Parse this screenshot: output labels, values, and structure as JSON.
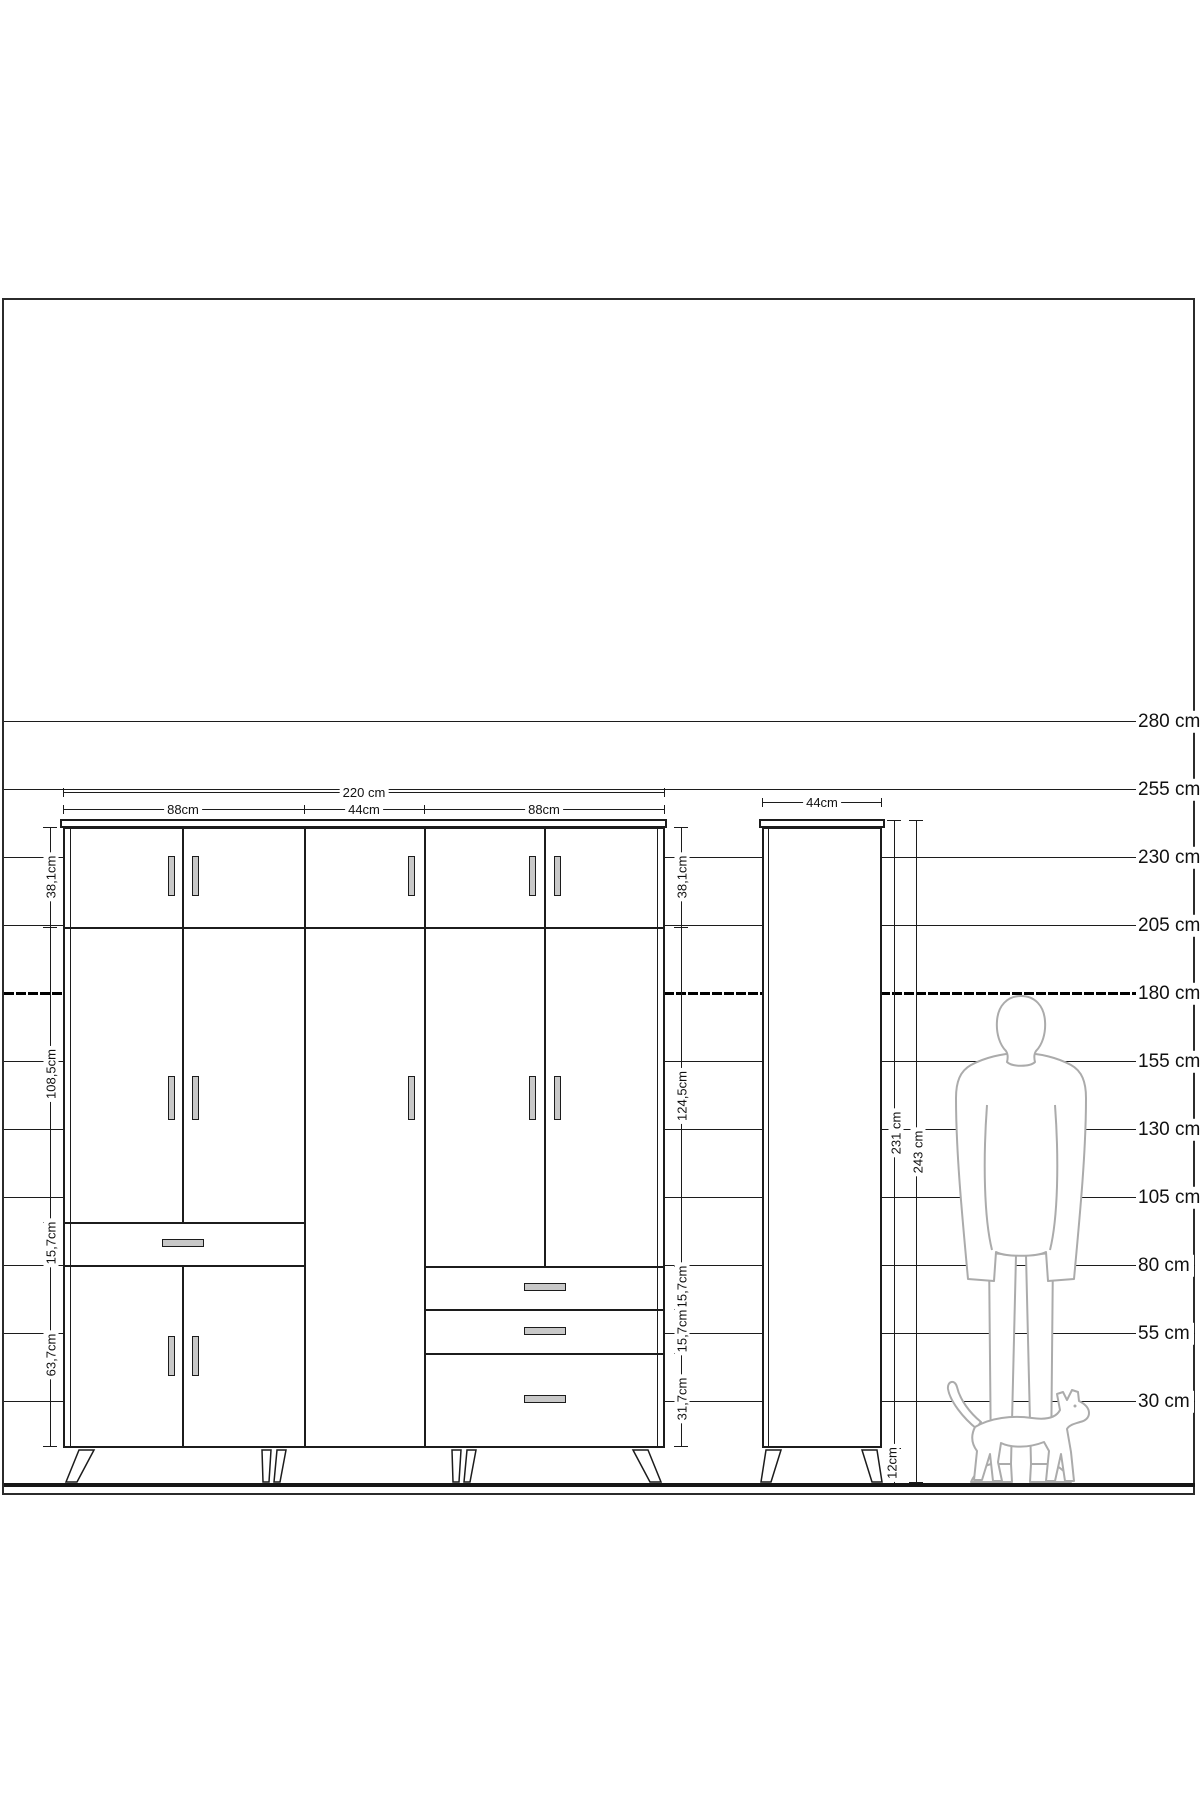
{
  "ruler": {
    "labels": [
      "280 cm",
      "255 cm",
      "230 cm",
      "205 cm",
      "180 cm",
      "155 cm",
      "130 cm",
      "105 cm",
      "80 cm",
      "55 cm",
      "30 cm"
    ],
    "bold_label": "180 cm"
  },
  "wardrobe": {
    "total_width_label": "220 cm",
    "section_width_labels": [
      "88cm",
      "44cm",
      "88cm"
    ],
    "left_height_labels": [
      "38,1cm",
      "108,5cm",
      "15,7cm",
      "63,7cm"
    ],
    "right_height_labels": [
      "38,1cm",
      "124,5cm",
      "15,7cm",
      "15,7cm",
      "31,7cm"
    ]
  },
  "cabinet": {
    "width_label": "44cm",
    "carcass_height_label": "231 cm",
    "total_height_label": "243 cm",
    "leg_height_label": "12cm"
  },
  "figures": {
    "man": "standing-man-scale-silhouette",
    "cat": "walking-cat-silhouette"
  },
  "colors": {
    "line": "#1c1c1c",
    "silhouette": "#ababab",
    "handle_fill": "#c8c8c8",
    "background": "#ffffff"
  }
}
